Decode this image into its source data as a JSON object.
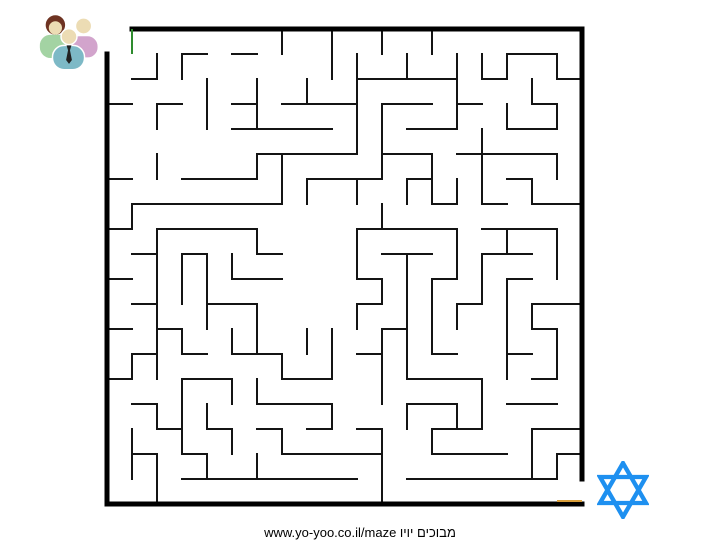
{
  "footer": {
    "text": "www.yo-yoo.co.il/maze מבוכים יויו"
  },
  "people_icon": {
    "name": "people-group-icon",
    "colors": {
      "skin": "#ecdcb4",
      "hair": "#6e3322",
      "green_shirt": "#a3d3a3",
      "pink_shirt": "#d2a4cc",
      "teal_shirt": "#7db9c6",
      "tie": "#222222",
      "outline": "#ffffff"
    }
  },
  "star_icon": {
    "name": "star-of-david-icon",
    "color": "#1e90f0",
    "stroke_width": 5
  },
  "maze": {
    "grid": {
      "cols": 19,
      "rows": 19,
      "cell_px": 25,
      "origin_x": 107,
      "origin_y": 29
    },
    "colors": {
      "wall": "#141414",
      "border": "#000000",
      "start": "#2e8b2e",
      "exit": "#d99e3a"
    },
    "wall_width": 1.8,
    "border_width": 5,
    "border_segments": [
      {
        "x1": 1,
        "y1": 0,
        "x2": 19,
        "y2": 0
      },
      {
        "x1": 19,
        "y1": 0,
        "x2": 19,
        "y2": 18
      },
      {
        "x1": 0,
        "y1": 19,
        "x2": 19,
        "y2": 19
      },
      {
        "x1": 0,
        "y1": 1,
        "x2": 0,
        "y2": 19
      }
    ],
    "start_marker": {
      "x": 1,
      "y1": 0,
      "y2": 1
    },
    "exit_marker": {
      "y": 19,
      "x1": 18,
      "x2": 19,
      "offset_y": -3
    },
    "h_walls": [
      [
        1,
        3,
        4
      ],
      [
        1,
        5,
        6
      ],
      [
        1,
        16,
        18
      ],
      [
        2,
        1,
        2
      ],
      [
        2,
        10,
        14
      ],
      [
        2,
        15,
        16
      ],
      [
        2,
        18,
        19
      ],
      [
        3,
        0,
        1
      ],
      [
        3,
        2,
        3
      ],
      [
        3,
        5,
        6
      ],
      [
        3,
        7,
        10
      ],
      [
        3,
        11,
        13
      ],
      [
        3,
        14,
        15
      ],
      [
        3,
        17,
        18
      ],
      [
        4,
        5,
        9
      ],
      [
        4,
        12,
        14
      ],
      [
        4,
        16,
        18
      ],
      [
        5,
        6,
        10
      ],
      [
        5,
        11,
        13
      ],
      [
        5,
        14,
        18
      ],
      [
        6,
        0,
        1
      ],
      [
        6,
        3,
        6
      ],
      [
        6,
        8,
        11
      ],
      [
        6,
        12,
        13
      ],
      [
        6,
        16,
        17
      ],
      [
        7,
        1,
        7
      ],
      [
        7,
        13,
        14
      ],
      [
        7,
        15,
        16
      ],
      [
        7,
        17,
        19
      ],
      [
        8,
        0,
        1
      ],
      [
        8,
        2,
        6
      ],
      [
        8,
        10,
        14
      ],
      [
        8,
        15,
        18
      ],
      [
        9,
        1,
        2
      ],
      [
        9,
        3,
        4
      ],
      [
        9,
        6,
        7
      ],
      [
        9,
        11,
        13
      ],
      [
        9,
        15,
        17
      ],
      [
        10,
        0,
        1
      ],
      [
        10,
        5,
        7
      ],
      [
        10,
        10,
        11
      ],
      [
        10,
        13,
        14
      ],
      [
        10,
        16,
        17
      ],
      [
        11,
        1,
        2
      ],
      [
        11,
        4,
        6
      ],
      [
        11,
        10,
        11
      ],
      [
        11,
        14,
        15
      ],
      [
        11,
        17,
        19
      ],
      [
        12,
        0,
        1
      ],
      [
        12,
        2,
        3
      ],
      [
        12,
        11,
        12
      ],
      [
        12,
        17,
        18
      ],
      [
        13,
        1,
        2
      ],
      [
        13,
        3,
        4
      ],
      [
        13,
        5,
        7
      ],
      [
        13,
        10,
        11
      ],
      [
        13,
        13,
        14
      ],
      [
        13,
        16,
        17
      ],
      [
        14,
        0,
        1
      ],
      [
        14,
        3,
        5
      ],
      [
        14,
        7,
        9
      ],
      [
        14,
        12,
        15
      ],
      [
        14,
        17,
        18
      ],
      [
        15,
        1,
        2
      ],
      [
        15,
        6,
        9
      ],
      [
        15,
        12,
        14
      ],
      [
        15,
        16,
        18
      ],
      [
        16,
        2,
        3
      ],
      [
        16,
        4,
        5
      ],
      [
        16,
        6,
        7
      ],
      [
        16,
        8,
        9
      ],
      [
        16,
        10,
        11
      ],
      [
        16,
        13,
        15
      ],
      [
        16,
        17,
        19
      ],
      [
        17,
        1,
        2
      ],
      [
        17,
        3,
        4
      ],
      [
        17,
        7,
        11
      ],
      [
        17,
        13,
        16
      ],
      [
        17,
        18,
        19
      ],
      [
        18,
        3,
        10
      ],
      [
        18,
        12,
        18
      ]
    ],
    "v_walls": [
      [
        1,
        7,
        8
      ],
      [
        1,
        13,
        14
      ],
      [
        1,
        16,
        18
      ],
      [
        2,
        1,
        2
      ],
      [
        2,
        3,
        4
      ],
      [
        2,
        5,
        6
      ],
      [
        2,
        8,
        14
      ],
      [
        2,
        15,
        16
      ],
      [
        2,
        17,
        19
      ],
      [
        3,
        1,
        2
      ],
      [
        3,
        9,
        11
      ],
      [
        3,
        12,
        13
      ],
      [
        3,
        14,
        17
      ],
      [
        4,
        2,
        4
      ],
      [
        4,
        9,
        12
      ],
      [
        4,
        15,
        16
      ],
      [
        4,
        17,
        18
      ],
      [
        5,
        9,
        10
      ],
      [
        5,
        12,
        13
      ],
      [
        5,
        14,
        15
      ],
      [
        5,
        16,
        17
      ],
      [
        6,
        2,
        4
      ],
      [
        6,
        5,
        6
      ],
      [
        6,
        8,
        9
      ],
      [
        6,
        11,
        13
      ],
      [
        6,
        14,
        15
      ],
      [
        6,
        17,
        18
      ],
      [
        7,
        0,
        1
      ],
      [
        7,
        5,
        7
      ],
      [
        7,
        13,
        14
      ],
      [
        7,
        16,
        17
      ],
      [
        8,
        2,
        3
      ],
      [
        8,
        6,
        7
      ],
      [
        8,
        12,
        13
      ],
      [
        9,
        0,
        2
      ],
      [
        9,
        12,
        14
      ],
      [
        9,
        15,
        16
      ],
      [
        10,
        1,
        5
      ],
      [
        10,
        6,
        7
      ],
      [
        10,
        8,
        10
      ],
      [
        10,
        11,
        12
      ],
      [
        11,
        0,
        1
      ],
      [
        11,
        3,
        6
      ],
      [
        11,
        7,
        8
      ],
      [
        11,
        10,
        11
      ],
      [
        11,
        12,
        15
      ],
      [
        11,
        16,
        19
      ],
      [
        12,
        1,
        2
      ],
      [
        12,
        6,
        7
      ],
      [
        12,
        9,
        14
      ],
      [
        12,
        15,
        16
      ],
      [
        13,
        0,
        1
      ],
      [
        13,
        5,
        7
      ],
      [
        13,
        10,
        13
      ],
      [
        13,
        16,
        17
      ],
      [
        14,
        1,
        4
      ],
      [
        14,
        6,
        7
      ],
      [
        14,
        8,
        10
      ],
      [
        14,
        11,
        12
      ],
      [
        14,
        15,
        16
      ],
      [
        15,
        1,
        2
      ],
      [
        15,
        4,
        7
      ],
      [
        15,
        9,
        11
      ],
      [
        15,
        14,
        16
      ],
      [
        16,
        1,
        2
      ],
      [
        16,
        3,
        4
      ],
      [
        16,
        8,
        9
      ],
      [
        16,
        10,
        14
      ],
      [
        17,
        2,
        3
      ],
      [
        17,
        6,
        7
      ],
      [
        17,
        11,
        12
      ],
      [
        17,
        16,
        18
      ],
      [
        18,
        1,
        2
      ],
      [
        18,
        3,
        4
      ],
      [
        18,
        5,
        6
      ],
      [
        18,
        8,
        10
      ],
      [
        18,
        12,
        14
      ],
      [
        18,
        17,
        18
      ]
    ]
  }
}
